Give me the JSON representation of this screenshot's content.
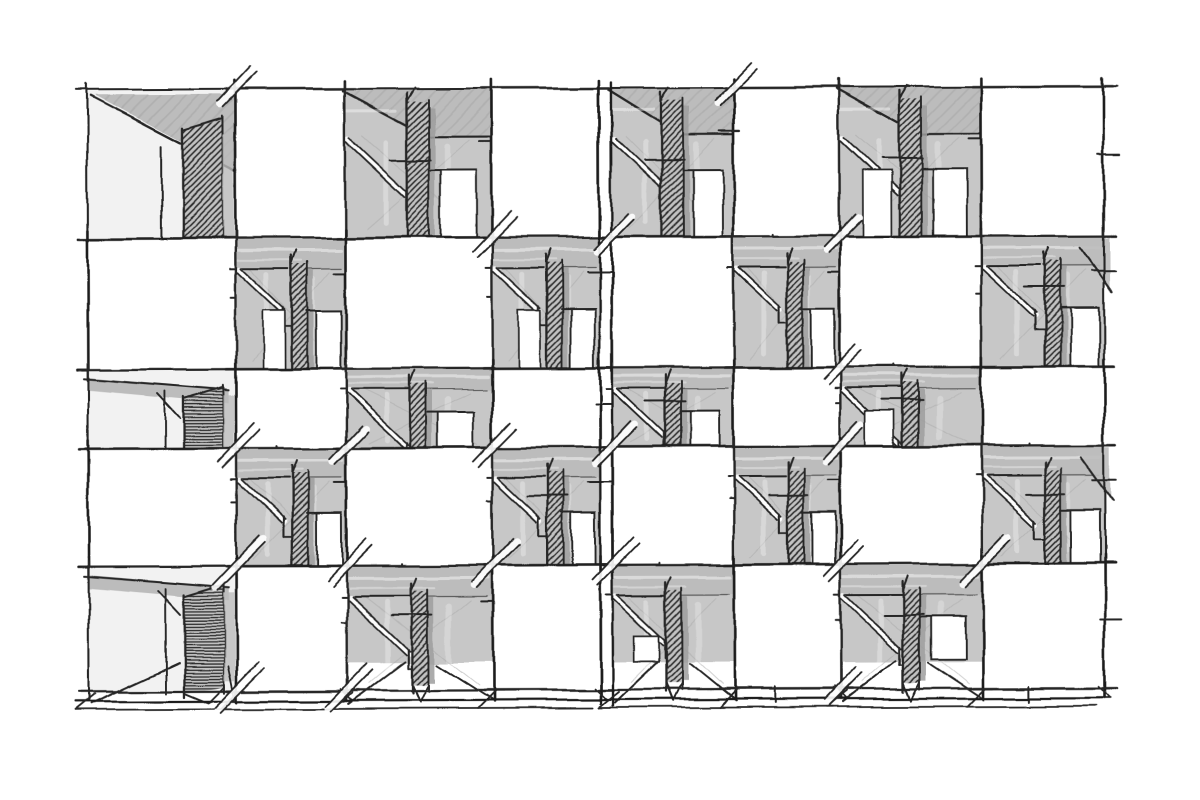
{
  "window": {
    "width": 1200,
    "height": 800,
    "background": "#ffffff"
  },
  "artwork": {
    "kind": "hand-drawn architectural facade sketch",
    "subject": "checkerboard facade study: protruding white volumes alternating with recessed shaded bays, each recess holding a dark hatched partition fin, diagonal railing strokes, perspective soffits on the top row and ground plinth lines at the base",
    "medium": "pencil and ink on white paper",
    "seed": 11
  },
  "palette": {
    "paper": "#ffffff",
    "ink": "#262626",
    "ink_heavy": "#1b1b1b",
    "recess_gray": "#c7c7c7",
    "soffit_gray": "#bcbcbc",
    "fin_base": "#c2c2c2",
    "fin_side": "#9e9e9e",
    "edge_bay_fill": "#f2f2f2",
    "faint_line": "#a8a8a8",
    "streak_white": "#ffffff",
    "soft_hatch": "#a4a4a4"
  },
  "layout": {
    "origin_x": 88,
    "origin_y": 88,
    "col_widths": [
      148,
      110,
      146,
      108,
      122,
      106,
      142,
      122
    ],
    "row_heights": [
      149,
      131,
      79,
      118,
      125
    ],
    "center_gap_after_col": 4,
    "center_gap_px": 12,
    "bottom_y": 690,
    "plinth_offsets": [
      10,
      18
    ],
    "seam_x": [
      600,
      612
    ]
  },
  "grid": {
    "rows": 5,
    "cols": 8,
    "modules": 4,
    "recess_rule": "(row + col) even",
    "cell_types": [
      [
        "recess",
        "box",
        "recess",
        "box",
        "recess",
        "box",
        "recess",
        "box"
      ],
      [
        "box",
        "recess",
        "box",
        "recess",
        "box",
        "recess",
        "box",
        "recess"
      ],
      [
        "recess",
        "box",
        "recess",
        "box",
        "recess",
        "box",
        "recess",
        "box"
      ],
      [
        "box",
        "recess",
        "box",
        "recess",
        "box",
        "recess",
        "box",
        "recess"
      ],
      [
        "recess",
        "box",
        "recess",
        "box",
        "recess",
        "box",
        "recess",
        "box"
      ]
    ],
    "fin_hatch_cycle": [
      "diag",
      "horiz"
    ],
    "fin_width_interior": 16,
    "fin_width_top_row": 22,
    "fin_width_edge_bay": 40,
    "soffit_band_max": 30,
    "brace_probability": 0.55,
    "window_probability": 0.8
  },
  "sketch_style": {
    "wobble_scale": 7,
    "noise_frequency": 0.013,
    "stroke_main": 2.1,
    "stroke_box": 2.6,
    "stroke_fine": 1.5,
    "global_tilt_deg": -0.2
  }
}
